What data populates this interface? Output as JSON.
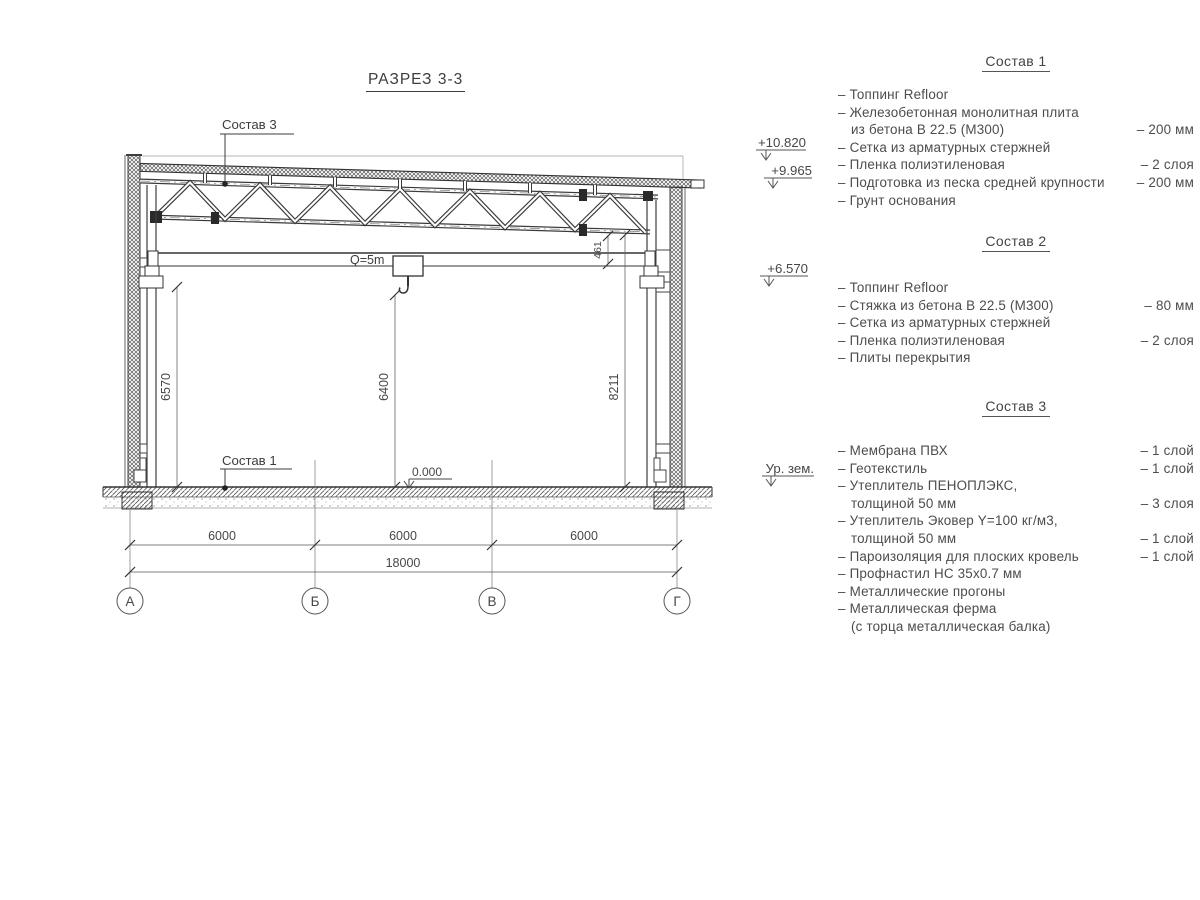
{
  "title": "РАЗРЕЗ 3-3",
  "callouts": {
    "roof": "Состав 3",
    "floor": "Состав 1",
    "crane_capacity": "Q=5m",
    "zero_level": "0.000"
  },
  "dims": {
    "h_left": "6570",
    "h_hook": "6400",
    "h_right": "8211",
    "truss_offset": "461",
    "span1": "6000",
    "span2": "6000",
    "span3": "6000",
    "total": "18000"
  },
  "axes": {
    "a1": "А",
    "a2": "Б",
    "a3": "В",
    "a4": "Г"
  },
  "elevations": {
    "parapet": "+10.820",
    "roof": "+9.965",
    "crane": "+6.570",
    "ground": "Ур. зем."
  },
  "legend": {
    "s1": {
      "heading": "Состав 1",
      "lines": [
        {
          "t": "– Топпинг Refloor",
          "v": ""
        },
        {
          "t": "– Железобетонная  монолитная плита",
          "v": ""
        },
        {
          "t": "из бетона В 22.5 (М300)",
          "v": "– 200 мм"
        },
        {
          "t": "– Сетка из арматурных стержней",
          "v": ""
        },
        {
          "t": "– Пленка полиэтиленовая",
          "v": "–  2 слоя"
        },
        {
          "t": "– Подготовка из песка средней крупности",
          "v": "– 200 мм"
        },
        {
          "t": "– Грунт основания",
          "v": ""
        }
      ]
    },
    "s2": {
      "heading": "Состав 2",
      "lines": [
        {
          "t": "– Топпинг Refloor",
          "v": ""
        },
        {
          "t": "– Стяжка из бетона В 22.5 (М300)",
          "v": "– 80 мм"
        },
        {
          "t": "– Сетка из арматурных стержней",
          "v": ""
        },
        {
          "t": "– Пленка полиэтиленовая",
          "v": "–  2 слоя"
        },
        {
          "t": "– Плиты перекрытия",
          "v": ""
        }
      ]
    },
    "s3": {
      "heading": "Состав 3",
      "lines": [
        {
          "t": "– Мембрана ПВХ",
          "v": "– 1 слой"
        },
        {
          "t": "– Геотекстиль",
          "v": "– 1 слой"
        },
        {
          "t": "– Утеплитель ПЕНОПЛЭКС,",
          "v": ""
        },
        {
          "t": "толщиной 50 мм",
          "v": "– 3 слоя"
        },
        {
          "t": "– Утеплитель Эковер Y=100 кг/м3,",
          "v": ""
        },
        {
          "t": "толщиной 50 мм",
          "v": "– 1 слой"
        },
        {
          "t": "– Пароизоляция для плоских кровель",
          "v": "– 1 слой"
        },
        {
          "t": "– Профнастил НС 35х0.7 мм",
          "v": ""
        },
        {
          "t": "– Металлические прогоны",
          "v": ""
        },
        {
          "t": "– Металлическая ферма",
          "v": ""
        },
        {
          "t": "(с торца металлическая балка)",
          "v": ""
        }
      ]
    }
  }
}
